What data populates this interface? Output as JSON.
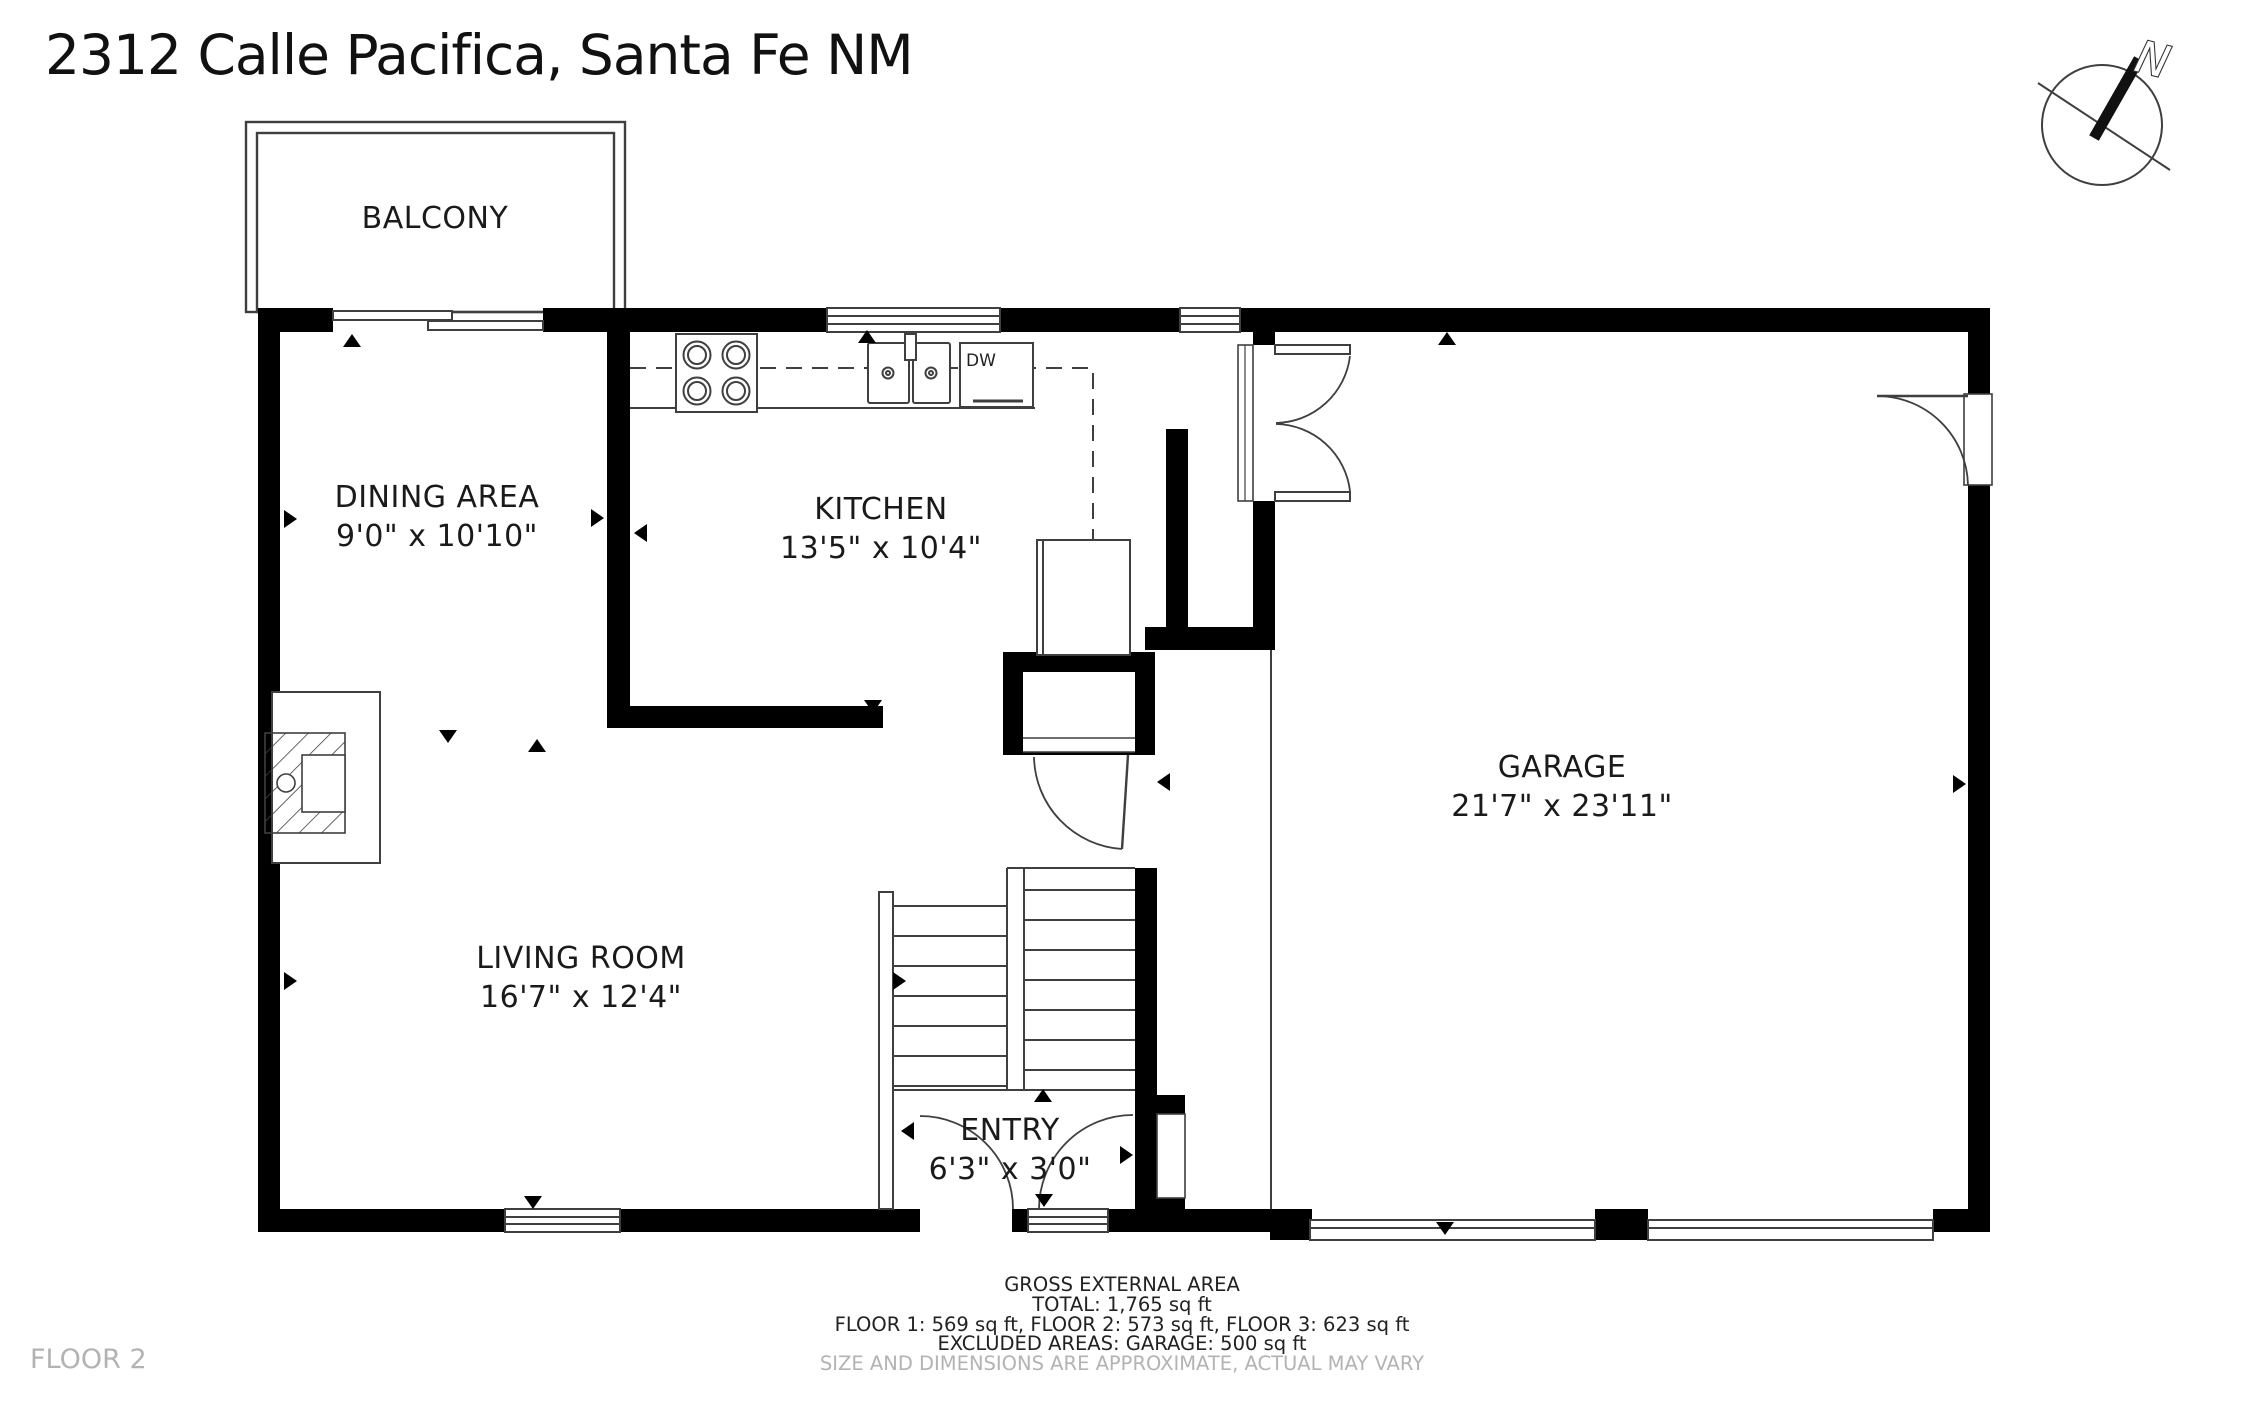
{
  "title": "2312 Calle Pacifica, Santa Fe NM",
  "floor_label": "FLOOR 2",
  "compass": {
    "north_label": "N"
  },
  "rooms": {
    "balcony": {
      "name": "BALCONY"
    },
    "dining": {
      "name": "DINING AREA",
      "dims": "9'0\" x 10'10\""
    },
    "kitchen": {
      "name": "KITCHEN",
      "dims": "13'5\" x 10'4\""
    },
    "garage": {
      "name": "GARAGE",
      "dims": "21'7\" x 23'11\""
    },
    "living": {
      "name": "LIVING ROOM",
      "dims": "16'7\" x 12'4\""
    },
    "entry": {
      "name": "ENTRY",
      "dims": "6'3\" x 3'0\""
    }
  },
  "fixtures": {
    "dishwasher_label": "DW"
  },
  "footer": {
    "line1": "GROSS EXTERNAL AREA",
    "line2": "TOTAL: 1,765 sq ft",
    "line3": "FLOOR 1: 569 sq ft, FLOOR 2: 573 sq ft, FLOOR 3: 623 sq ft",
    "line4": "EXCLUDED AREAS: GARAGE: 500 sq ft",
    "disclaimer": "SIZE AND DIMENSIONS ARE APPROXIMATE, ACTUAL MAY VARY"
  },
  "colors": {
    "wall": "#000000",
    "thin_line": "#3f3f3f",
    "text": "#1a1a1a",
    "muted_text": "#b3b3b3",
    "background": "#ffffff"
  }
}
